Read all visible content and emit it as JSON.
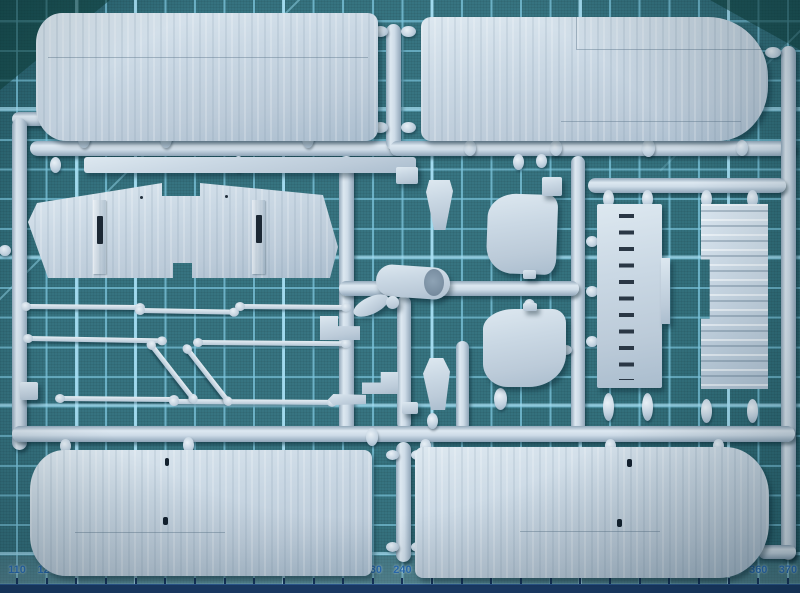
{
  "mat": {
    "angle_label": "45°",
    "colors": {
      "mat_base": "#36727f",
      "grid_line": "#74c2dc",
      "ruler_text": "#2b6db4",
      "bottom_strip": "#1c3c69",
      "plastic": "#c6d4e1"
    }
  },
  "ruler": {
    "marks": [
      {
        "label": "110",
        "major": false
      },
      {
        "label": "120",
        "major": false
      },
      {
        "label": "130",
        "major": false
      },
      {
        "label": "140",
        "major": false
      },
      {
        "label": "150",
        "major": true
      },
      {
        "label": "160",
        "major": false
      },
      {
        "label": "170",
        "major": false
      },
      {
        "label": "180",
        "major": false
      },
      {
        "label": "190",
        "major": false
      },
      {
        "label": "200",
        "major": true
      },
      {
        "label": "210",
        "major": false
      },
      {
        "label": "220",
        "major": false
      },
      {
        "label": "230",
        "major": false
      },
      {
        "label": "240",
        "major": false
      },
      {
        "label": "250",
        "major": true
      },
      {
        "label": "260",
        "major": false
      },
      {
        "label": "270",
        "major": false
      },
      {
        "label": "280",
        "major": false
      },
      {
        "label": "290",
        "major": false
      },
      {
        "label": "300",
        "major": true
      },
      {
        "label": "310",
        "major": false
      },
      {
        "label": "320",
        "major": false
      },
      {
        "label": "330",
        "major": false
      },
      {
        "label": "340",
        "major": false
      },
      {
        "label": "350",
        "major": true
      },
      {
        "label": "360",
        "major": false
      },
      {
        "label": "370",
        "major": false
      }
    ]
  },
  "sprue": {
    "parts": [
      "upper-wing-left",
      "upper-wing-right",
      "lower-wing-left",
      "lower-wing-right",
      "wing-center-section",
      "walkway-strip",
      "slotted-floor-panel",
      "corrugated-panel",
      "fuselage-deck-front",
      "fuselage-deck-rear",
      "engine-cowling",
      "propeller-blade",
      "fin",
      "cabane",
      "interplane-struts",
      "small-brackets"
    ]
  }
}
